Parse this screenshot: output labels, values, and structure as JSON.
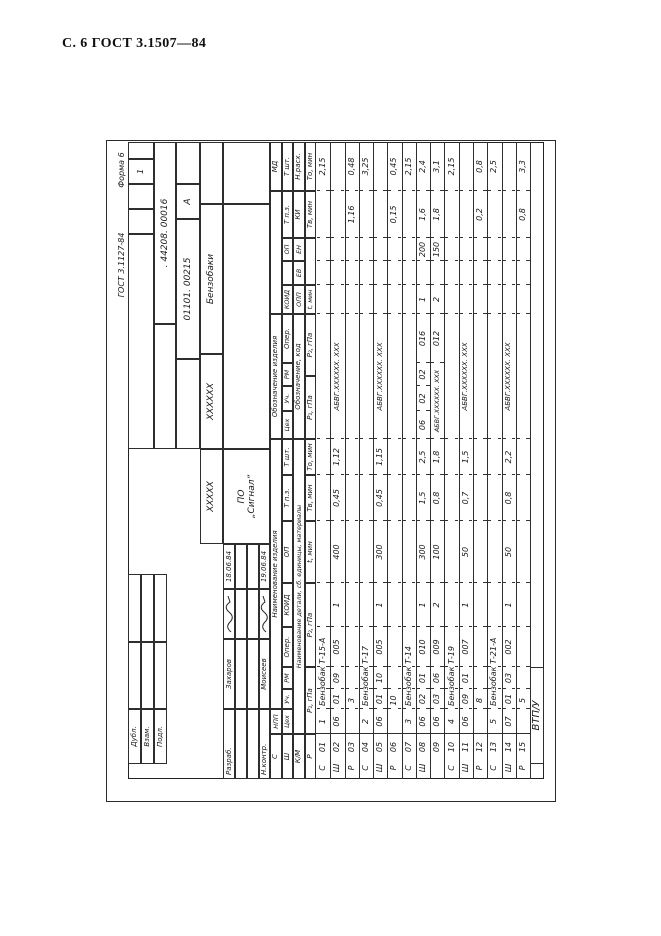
{
  "page": {
    "header": "С. 6 ГОСТ 3.1507—84"
  },
  "form": {
    "standard_ref": "ГОСТ 3.1127-84",
    "form_label": "Форма 6",
    "sheet_no": "1",
    "code_top": ". 44208. 00016",
    "doc_no": "01101. 00215",
    "litera": "А",
    "code_x6": "ХХХХХХ",
    "code_x5": "ХХХХХ",
    "product_group": "Бензобаки",
    "org_line1": "ПО",
    "org_line2": "„Сигнал”",
    "left_block": [
      "Дубл.",
      "Взам.",
      "Подл."
    ],
    "title_block": [
      {
        "role": "Разраб.",
        "name": "Захаров",
        "date": "18.06.84"
      },
      {
        "role": "Н.контр.",
        "name": "Моисеев",
        "date": "19.06.84"
      }
    ],
    "footer_code": "ВТП/У",
    "header_labels": {
      "s": "С",
      "sh": "Ш",
      "km": "К/М",
      "r": "Р",
      "npp": "НПП",
      "naim_izd": "Наименование изделия",
      "obozn_izd": "Обозначение изделия",
      "ceh": "Цех",
      "uch": "Уч.",
      "rm": "РМ",
      "oper": "Опер.",
      "koid": "КОИД",
      "op": "ОП",
      "tpz": "Т п.з.",
      "tsht": "Т шт.",
      "naim_det": "Наименование детали, сб. единицы, материалы",
      "obozn_kod": "Обозначение, код",
      "opp": "ОПП",
      "ev": "ЕВ",
      "en": "ЕН",
      "ki": "КИ",
      "nrash": "Н.расх.",
      "md": "МД",
      "p1": "Р₁, гПа",
      "p2": "Р₂, гПа",
      "tmin": "t, мин",
      "tv": "Тв, мин",
      "to": "То, мин"
    },
    "rows": [
      {
        "sym": "С",
        "num": "01",
        "npp": "1",
        "name": "Бензобак Т-15-А",
        "md": "2,15"
      },
      {
        "sym": "Ш",
        "num": "02",
        "ceh": "06",
        "uch": "01",
        "rm": "09",
        "oper": "005",
        "koid": "1",
        "op": "400",
        "tpz": "0,45",
        "tsht": "1,12",
        "doc": "АБВГ.ХХХХХХ. ХХХ"
      },
      {
        "sym": "Р",
        "num": "03",
        "p1": "3",
        "tv": "1,16",
        "to": "0,48"
      },
      {
        "sym": "С",
        "num": "04",
        "npp": "2",
        "name": "Бензобак Т-17",
        "md": "3,25"
      },
      {
        "sym": "Ш",
        "num": "05",
        "ceh": "06",
        "uch": "01",
        "rm": "10",
        "oper": "005",
        "koid": "1",
        "op": "300",
        "tpz": "0,45",
        "tsht": "1,15",
        "doc": "АБВГ.ХХХХХХ. ХХХ"
      },
      {
        "sym": "Р",
        "num": "06",
        "p1": "10",
        "tv": "0,15",
        "to": "0,45"
      },
      {
        "sym": "С",
        "num": "07",
        "npp": "3",
        "name": "Бензобак Т-14",
        "md": "2,15"
      },
      {
        "sym": "Ш",
        "num": "08",
        "ceh": "06",
        "uch": "02",
        "rm": "01",
        "oper": "010",
        "koid": "1",
        "op": "300",
        "tpz": "1,5",
        "tsht": "2,5",
        "ceh2": "06",
        "uch2": "02",
        "rm2": "02",
        "oper2": "016",
        "koid2": "1",
        "op2": "200",
        "tpz2": "1,6",
        "tsht2": "2,4"
      },
      {
        "sym": "",
        "num": "09",
        "ceh": "06",
        "uch": "03",
        "rm": "06",
        "oper": "009",
        "koid": "2",
        "op": "100",
        "tpz": "0,8",
        "tsht": "1,8",
        "doc": "АБВГ.ХХХХХХ. ХХХ",
        "oper2": "012",
        "koid2": "2",
        "op2": "150",
        "tpz2": "1,8",
        "tsht2": "3,1"
      },
      {
        "sym": "С",
        "num": "10",
        "npp": "4",
        "name": "Бензобак Т-19",
        "md": "2,15"
      },
      {
        "sym": "Ш",
        "num": "11",
        "ceh": "06",
        "uch": "09",
        "rm": "01",
        "oper": "007",
        "koid": "1",
        "op": "50",
        "tpz": "0,7",
        "tsht": "1,5",
        "doc": "АБВГ.ХХХХХХ. ХХХ"
      },
      {
        "sym": "Р",
        "num": "12",
        "p1": "8",
        "tv": "0,2",
        "to": "0,8"
      },
      {
        "sym": "С",
        "num": "13",
        "npp": "5",
        "name": "Бензобак Т-21-А",
        "md": "2,5"
      },
      {
        "sym": "Ш",
        "num": "14",
        "ceh": "07",
        "uch": "01",
        "rm": "03",
        "oper": "002",
        "koid": "1",
        "op": "50",
        "tpz": "0,8",
        "tsht": "2,2",
        "doc": "АБВГ.ХХХХХХ. ХХХ"
      },
      {
        "sym": "Р",
        "num": "15",
        "p1": "5",
        "tv": "0,8",
        "to": "3,3"
      }
    ]
  }
}
